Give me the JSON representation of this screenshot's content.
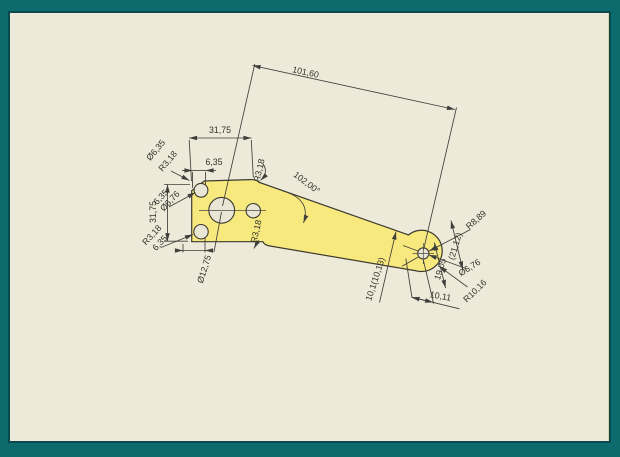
{
  "drawing": {
    "type": "cad-part-dimension-view",
    "colors": {
      "background": "#edead9",
      "frame": "#0e6b6d",
      "frame_inner_line": "#0a4a4e",
      "part_fill": "#f8e97f",
      "line": "#3f3f3b"
    },
    "dims": {
      "overall_length": "101,60",
      "head_width_top": "31,75",
      "hole_offset_top": "6,35",
      "head_height": "31,75",
      "chamfer_hole_dia": "Ø6,35",
      "chamfer_radius": "R3,18",
      "top_left_offset": "6,35",
      "top_left_hole_dia": "Ø6,76",
      "bottom_left_radius": "R3,18",
      "bottom_left_offset": "6,35",
      "center_hole_dia": "Ø12,75",
      "top_corner_radius": "R3,18",
      "taper_angle": "102,00°",
      "bottom_fillet_radius": "R3,18",
      "tip_span_ref": "10,1(10,13)",
      "tip_outer_radius": "R8,89",
      "tip_width_ref": "(21,12)",
      "tip_hole_dia": "Ø6,76",
      "tip_end_radius": "R10,16",
      "tip_offset_horizontal": "10,11",
      "tip_offset_vertical": "19,05"
    }
  }
}
